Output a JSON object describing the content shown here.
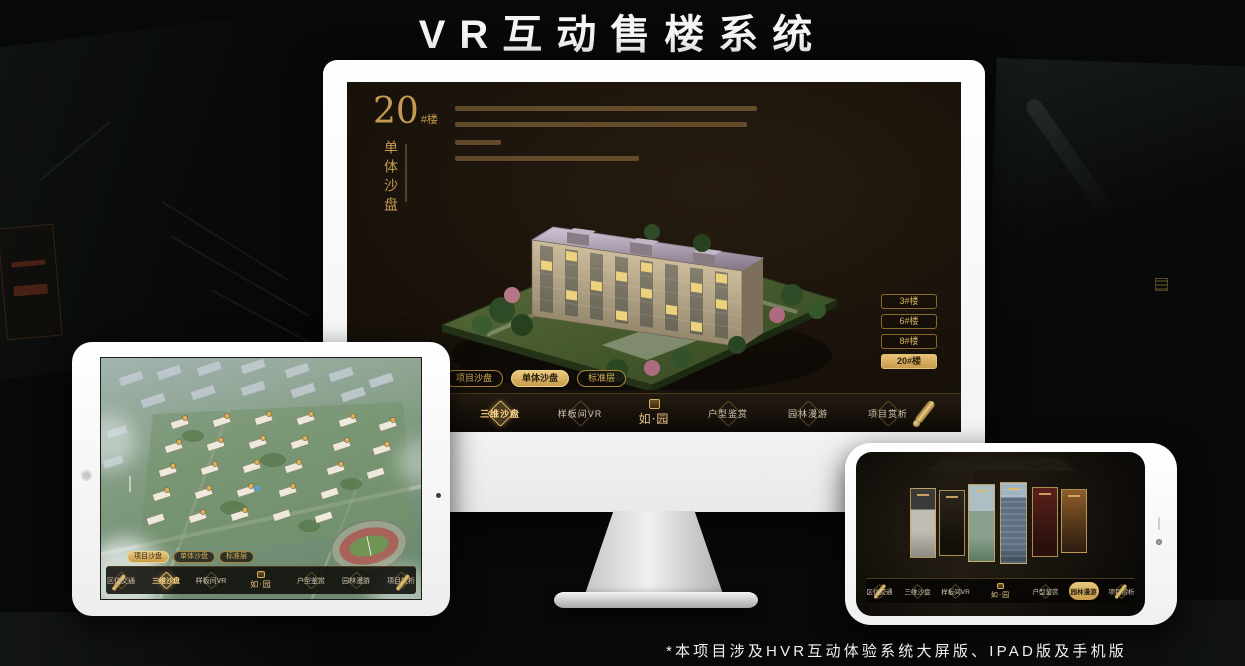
{
  "page": {
    "title": "VR互动售楼系统",
    "footnote": "*本项目涉及HVR互动体验系统大屏版、IPAD版及手机版"
  },
  "colors": {
    "accent_gold": "#c9a254",
    "accent_gold_bright": "#e9c87e",
    "screen_dark": "#1a130b"
  },
  "monitor": {
    "heading": {
      "number": "20",
      "suffix": "#楼",
      "subtitle_vertical": "单体沙盘"
    },
    "building_buttons": [
      {
        "label": "3#楼",
        "selected": false
      },
      {
        "label": "6#楼",
        "selected": false
      },
      {
        "label": "8#楼",
        "selected": false
      },
      {
        "label": "20#楼",
        "selected": true
      }
    ],
    "sub_tabs": [
      {
        "label": "项目沙盘",
        "selected": false
      },
      {
        "label": "单体沙盘",
        "selected": true
      },
      {
        "label": "标准层",
        "selected": false
      }
    ],
    "nav": {
      "logo": "如·园",
      "items": [
        {
          "label": "区位交通",
          "selected": false
        },
        {
          "label": "三维沙盘",
          "selected": true
        },
        {
          "label": "样板间VR",
          "selected": false
        },
        {
          "label": "户型鉴赏",
          "selected": false
        },
        {
          "label": "园林漫游",
          "selected": false
        },
        {
          "label": "项目赏析",
          "selected": false
        }
      ]
    }
  },
  "tablet": {
    "sub_tabs": [
      {
        "label": "项目沙盘",
        "selected": true
      },
      {
        "label": "单体沙盘",
        "selected": false
      },
      {
        "label": "标准层",
        "selected": false
      }
    ],
    "nav": {
      "logo": "如·园",
      "items": [
        {
          "label": "区位交通",
          "selected": false
        },
        {
          "label": "三维沙盘",
          "selected": true
        },
        {
          "label": "样板间VR",
          "selected": false
        },
        {
          "label": "户型鉴赏",
          "selected": false
        },
        {
          "label": "园林漫游",
          "selected": false
        },
        {
          "label": "项目赏析",
          "selected": false
        }
      ]
    }
  },
  "phone": {
    "nav": {
      "logo": "如·园",
      "items": [
        {
          "label": "区位交通",
          "selected": false
        },
        {
          "label": "三维沙盘",
          "selected": false
        },
        {
          "label": "样板间VR",
          "selected": false
        },
        {
          "label": "户型鉴赏",
          "selected": false
        },
        {
          "label": "园林漫游",
          "selected": true
        },
        {
          "label": "项目赏析",
          "selected": false
        }
      ]
    }
  }
}
